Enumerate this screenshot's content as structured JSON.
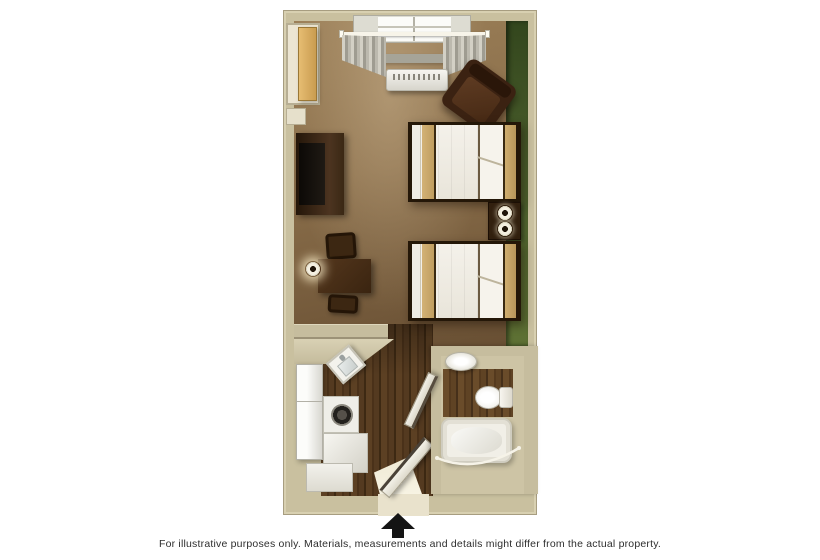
{
  "caption": {
    "text": "For illustrative purposes only.  Materials, measurements and details might differ from the actual property."
  },
  "entrance": {
    "arrow_icon": "up-arrow",
    "arrow_glyph": "▲",
    "arrow_color": "#141414"
  },
  "floorplan": {
    "view": "top-down-3d-room-rendering",
    "colors": {
      "wall": "#c9c09f",
      "accent_wall_green": "#4a5e2c",
      "carpet_brown": "#8a6e4a",
      "wood_floor": "#4e3520",
      "furniture_dark_wood": "#3b2212",
      "bedding_white": "#f2efe8",
      "bedding_tan_accent": "#c9a765",
      "fixture_white": "#f1efe7",
      "closet_door_tan": "#d9b061",
      "curtain_gray": "#b5b2a8"
    },
    "rooms": {
      "main_room": {
        "items": [
          "closet",
          "shelf-niche",
          "window",
          "curtain-rod",
          "curtains",
          "ac-unit",
          "armchair",
          "tv-dresser",
          "television",
          "desk",
          "desk-chairs",
          "desk-lamp",
          "bed-1",
          "bed-2",
          "nightstand",
          "table-lamp-1",
          "table-lamp-2",
          "accent-wall"
        ]
      },
      "kitchenette": {
        "items": [
          "counter",
          "kitchen-sink",
          "refrigerator",
          "stove",
          "base-cabinets"
        ]
      },
      "bathroom": {
        "items": [
          "vanity-sink",
          "toilet",
          "bathtub",
          "shower-curtain-rod",
          "bathroom-door"
        ]
      },
      "entry": {
        "items": [
          "doorway",
          "entry-door",
          "door-light"
        ]
      }
    }
  }
}
